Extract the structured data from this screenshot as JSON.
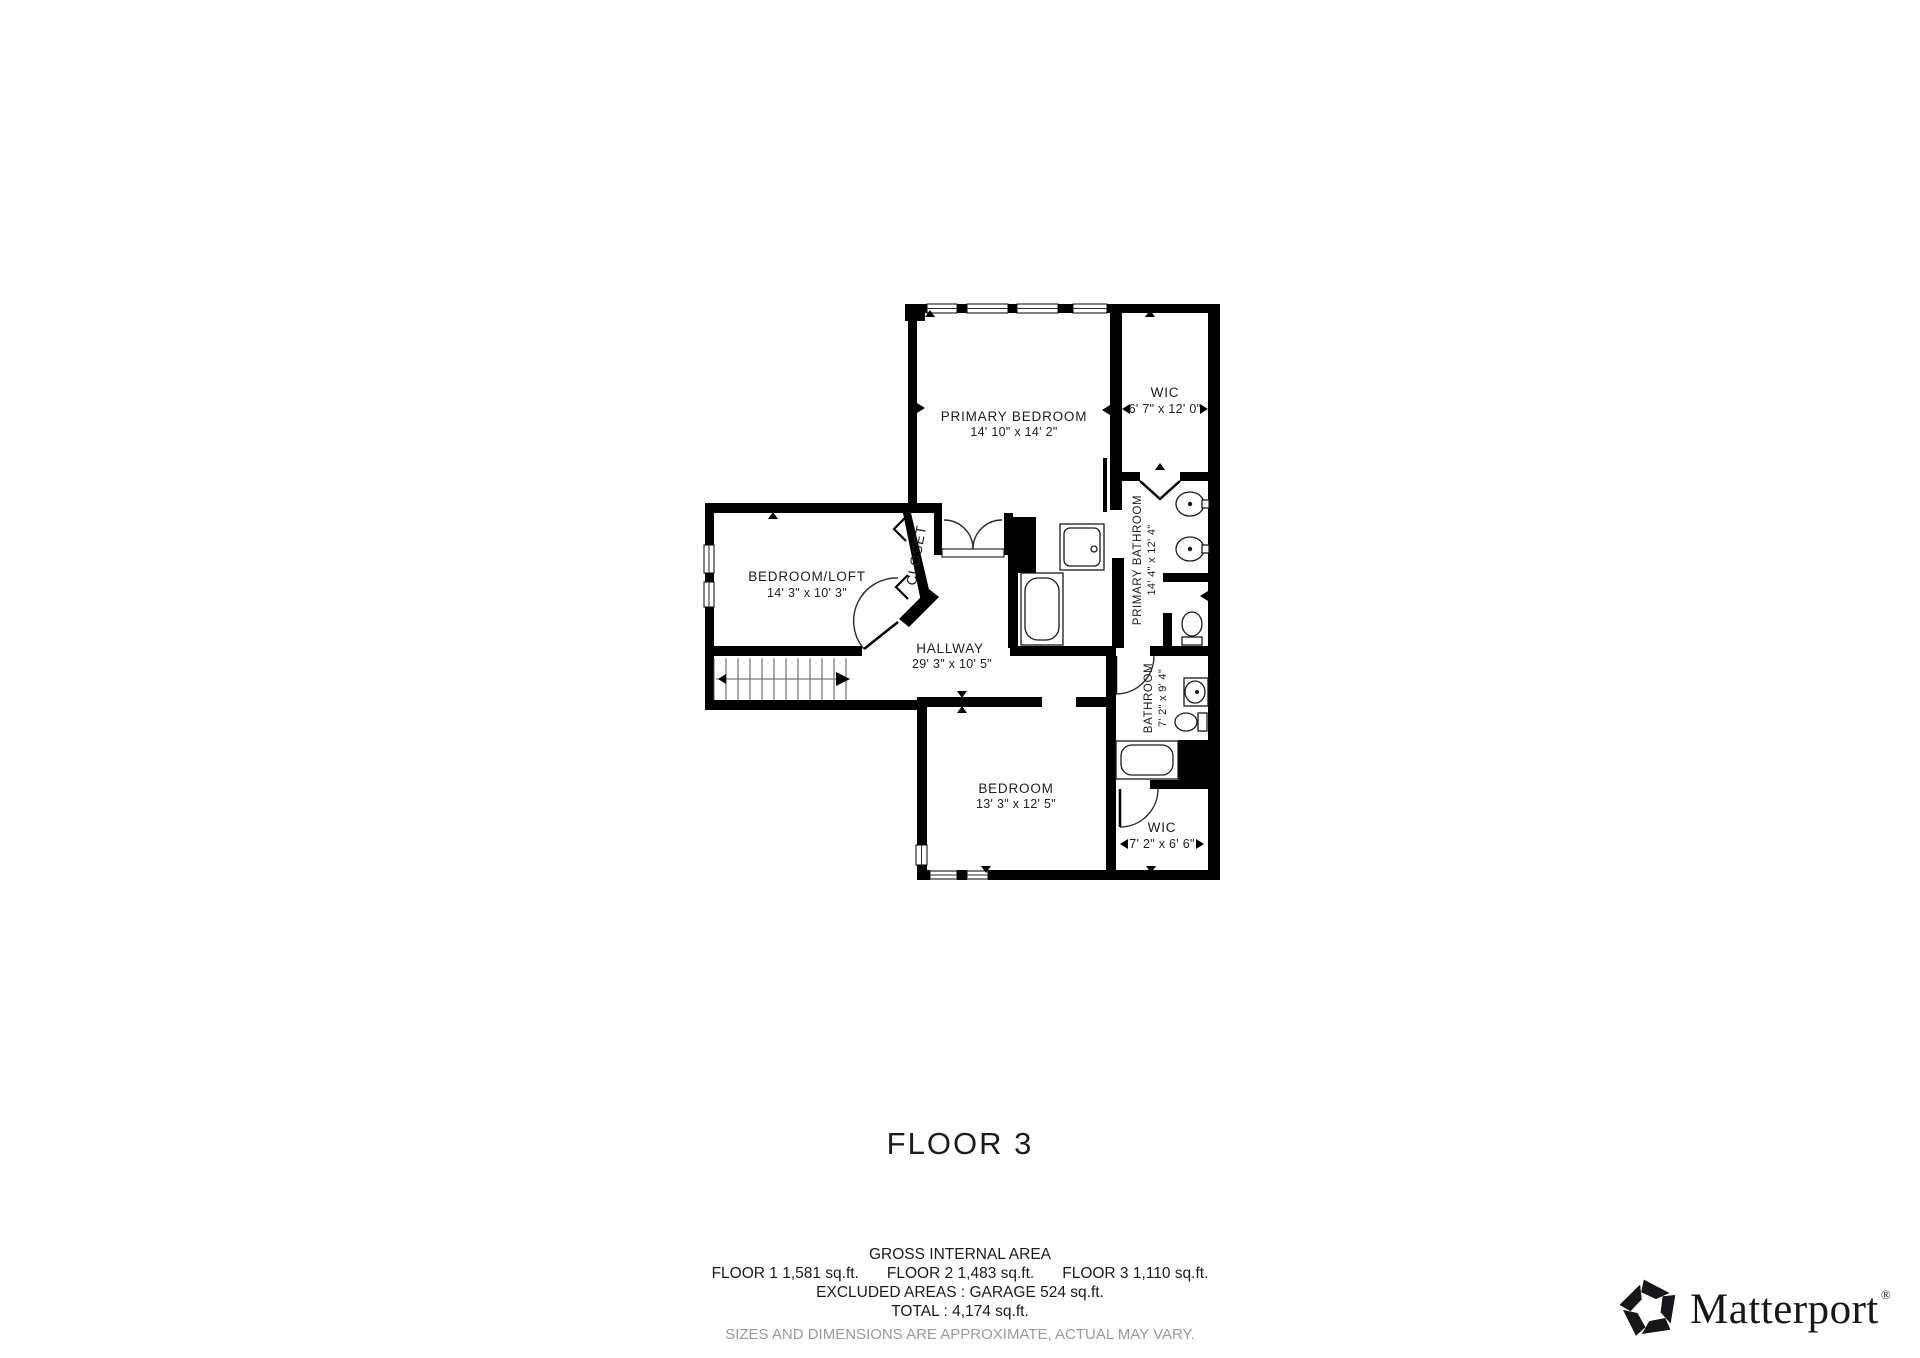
{
  "plan": {
    "title": "FLOOR 3",
    "rooms": {
      "primary_bedroom": {
        "name": "PRIMARY BEDROOM",
        "dims": "14' 10\" x 14' 2\""
      },
      "wic_upper": {
        "name": "WIC",
        "dims": "6' 7\" x 12' 0\""
      },
      "primary_bathroom": {
        "name": "PRIMARY BATHROOM",
        "dims": "14' 4\" x 12' 4\""
      },
      "closet": {
        "name": "CLOSET"
      },
      "bedroom_loft": {
        "name": "BEDROOM/LOFT",
        "dims": "14' 3\" x 10' 3\""
      },
      "hallway": {
        "name": "HALLWAY",
        "dims": "29' 3\" x 10' 5\""
      },
      "bathroom": {
        "name": "BATHROOM",
        "dims": "7' 2\" x 9' 4\""
      },
      "bedroom": {
        "name": "BEDROOM",
        "dims": "13' 3\" x 12' 5\""
      },
      "wic_lower": {
        "name": "WIC",
        "dims": "7' 2\" x 6' 6\""
      }
    }
  },
  "footer": {
    "gross_internal_area": "GROSS INTERNAL AREA",
    "floor_areas": [
      "FLOOR 1 1,581 sq.ft.",
      "FLOOR 2 1,483 sq.ft.",
      "FLOOR 3 1,110 sq.ft."
    ],
    "excluded_areas": "EXCLUDED AREAS :  GARAGE 524 sq.ft.",
    "total": "TOTAL :  4,174 sq.ft.",
    "disclaimer": "SIZES AND DIMENSIONS ARE APPROXIMATE, ACTUAL MAY VARY."
  },
  "branding": {
    "wordmark": "Matterport",
    "registered": "®"
  },
  "colors": {
    "wall": "#000000",
    "text": "#1d1d1f",
    "muted": "#9a9a9a",
    "background": "#ffffff"
  }
}
